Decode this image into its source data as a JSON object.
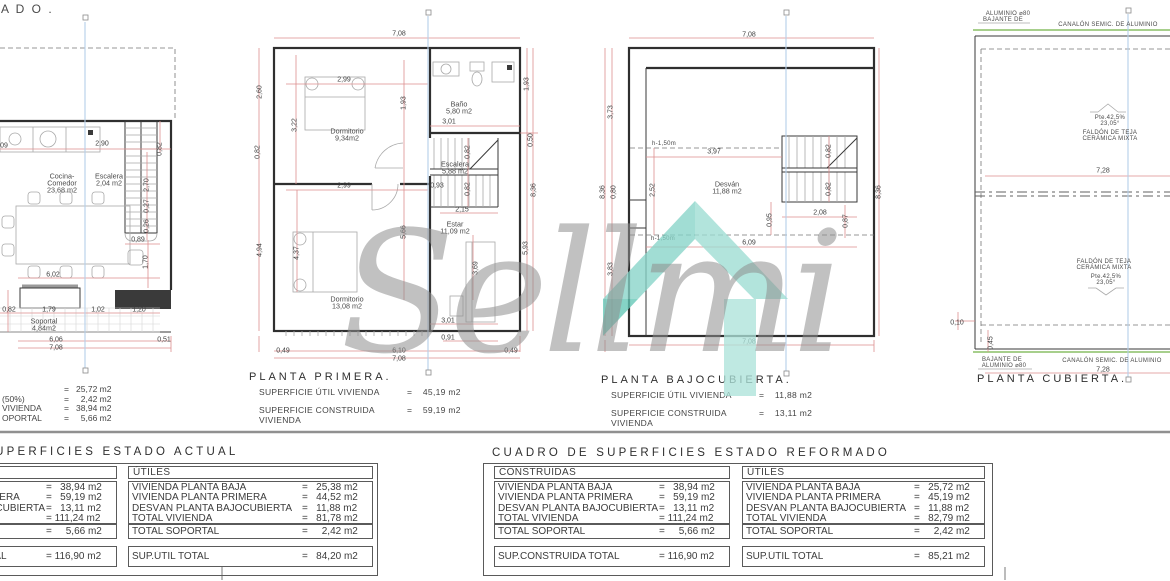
{
  "sheet": {
    "partial_title": "A D O ."
  },
  "watermark": {
    "text": "Sellmi",
    "teal_dark": "#7fd0c2",
    "teal_light": "#aee2d8",
    "gray": "#8f8f8f"
  },
  "captions": {
    "primera": {
      "title": "PLANTA PRIMERA.",
      "lines": [
        {
          "label": "SUPERFICIE ÚTIL VIVIENDA",
          "value": "=    45,19 m2"
        },
        {
          "label": "SUPERFICIE CONSTRUIDA VIVIENDA",
          "value": "=    59,19 m2"
        }
      ]
    },
    "bajocubierta": {
      "title": "PLANTA BAJOCUBIERTA.",
      "lines": [
        {
          "label": "SUPERFICIE ÚTIL VIVIENDA",
          "value": "=    11,88 m2"
        },
        {
          "label": "SUPERFICIE CONSTRUIDA VIVIENDA",
          "value": "=    13,11 m2"
        }
      ]
    },
    "cubierta": {
      "title": "PLANTA CUBIERTA."
    }
  },
  "left_summary": {
    "rows": [
      {
        "label": "",
        "value": "=   25,72 m2"
      },
      {
        "label": "(50%)",
        "value": "=     2,42 m2"
      },
      {
        "label": "VIVIENDA",
        "value": "=   38,94 m2"
      },
      {
        "label": "OPORTAL",
        "value": "=     5,66 m2"
      }
    ]
  },
  "tables": {
    "actual": {
      "title": "CUADRO DE SUPERFICIES ESTADO ACTUAL",
      "construidas": {
        "header": "CONSTRUIDAS",
        "rows": [
          {
            "label": "VIVIENDA PLANTA BAJA",
            "value": "=   38,94 m2"
          },
          {
            "label": "VIVIENDA PLANTA PRIMERA",
            "value": "=   59,19 m2"
          },
          {
            "label": "DESVÁN PLANTA BAJOCUBIERTA",
            "value": "=   13,11 m2"
          },
          {
            "label": "TOTAL VIVIENDA",
            "value": "= 111,24 m2"
          }
        ],
        "soportal": {
          "label": "TOTAL SOPORTAL",
          "value": "=     5,66 m2"
        },
        "total": {
          "label": "SUP.CONSTRUIDA TOTAL",
          "value": "= 116,90 m2"
        }
      },
      "utiles": {
        "header": "ÚTILES",
        "rows": [
          {
            "label": "VIVIENDA PLANTA BAJA",
            "value": "=   25,38 m2"
          },
          {
            "label": "VIVIENDA PLANTA PRIMERA",
            "value": "=   44,52 m2"
          },
          {
            "label": "DESVÁN PLANTA BAJOCUBIERTA",
            "value": "=   11,88 m2"
          },
          {
            "label": "TOTAL VIVIENDA",
            "value": "=   81,78 m2"
          }
        ],
        "soportal": {
          "label": "TOTAL SOPORTAL",
          "value": "=     2,42 m2"
        },
        "total": {
          "label": "SUP.ÚTIL TOTAL",
          "value": "=   84,20 m2"
        }
      }
    },
    "reformado": {
      "title": "CUADRO DE SUPERFICIES ESTADO REFORMADO",
      "construidas": {
        "header": "CONSTRUIDAS",
        "rows": [
          {
            "label": "VIVIENDA PLANTA BAJA",
            "value": "=   38,94 m2"
          },
          {
            "label": "VIVIENDA PLANTA PRIMERA",
            "value": "=   59,19 m2"
          },
          {
            "label": "DESVÁN PLANTA BAJOCUBIERTA",
            "value": "=   13,11 m2"
          },
          {
            "label": "TOTAL VIVIENDA",
            "value": "= 111,24 m2"
          }
        ],
        "soportal": {
          "label": "TOTAL SOPORTAL",
          "value": "=     5,66 m2"
        },
        "total": {
          "label": "SUP.CONSTRUIDA TOTAL",
          "value": "= 116,90 m2"
        }
      },
      "utiles": {
        "header": "ÚTILES",
        "rows": [
          {
            "label": "VIVIENDA PLANTA BAJA",
            "value": "=   25,72 m2"
          },
          {
            "label": "VIVIENDA PLANTA PRIMERA",
            "value": "=   45,19 m2"
          },
          {
            "label": "DESVÁN PLANTA BAJOCUBIERTA",
            "value": "=   11,88 m2"
          },
          {
            "label": "TOTAL VIVIENDA",
            "value": "=   82,79 m2"
          }
        ],
        "soportal": {
          "label": "TOTAL SOPORTAL",
          "value": "=     2,42 m2"
        },
        "total": {
          "label": "SUP.ÚTIL TOTAL",
          "value": "=   85,21 m2"
        }
      }
    }
  },
  "labels": [
    {
      "t": "09",
      "x": 4,
      "y": 146,
      "c": "dim"
    },
    {
      "t": "2,90",
      "x": 102,
      "y": 144,
      "c": "dim"
    },
    {
      "t": "0,82",
      "x": 160,
      "y": 149,
      "r": 1,
      "c": "dim"
    },
    {
      "t": "Escalera",
      "x": 109,
      "y": 176,
      "c": "room"
    },
    {
      "t": "2,04 m2",
      "x": 109,
      "y": 183,
      "c": "room"
    },
    {
      "t": "Cocina-",
      "x": 62,
      "y": 176,
      "c": "room"
    },
    {
      "t": "Comedor",
      "x": 62,
      "y": 183,
      "c": "room"
    },
    {
      "t": "23,68 m2",
      "x": 62,
      "y": 190,
      "c": "room"
    },
    {
      "t": "2,70",
      "x": 147,
      "y": 185,
      "r": 1,
      "c": "dim"
    },
    {
      "t": "0,27",
      "x": 147,
      "y": 206,
      "r": 1,
      "c": "dim"
    },
    {
      "t": "0,26",
      "x": 147,
      "y": 226,
      "r": 1,
      "c": "dim"
    },
    {
      "t": "0,89",
      "x": 138,
      "y": 240,
      "c": "dim"
    },
    {
      "t": "1,70",
      "x": 146,
      "y": 262,
      "r": 1,
      "c": "dim"
    },
    {
      "t": "6,02",
      "x": 53,
      "y": 275,
      "c": "dim"
    },
    {
      "t": "0,82",
      "x": 9,
      "y": 310,
      "c": "dim"
    },
    {
      "t": "1,79",
      "x": 49,
      "y": 310,
      "c": "dim"
    },
    {
      "t": "1,02",
      "x": 98,
      "y": 310,
      "c": "dim"
    },
    {
      "t": "1,20",
      "x": 139,
      "y": 310,
      "c": "dim"
    },
    {
      "t": "Soportal",
      "x": 44,
      "y": 321,
      "c": "room"
    },
    {
      "t": "4,84m2",
      "x": 44,
      "y": 328,
      "c": "room"
    },
    {
      "t": "6,06",
      "x": 56,
      "y": 340,
      "c": "dim"
    },
    {
      "t": "0,51",
      "x": 164,
      "y": 340,
      "c": "dim"
    },
    {
      "t": "7,08",
      "x": 56,
      "y": 348,
      "c": "dim"
    },
    {
      "t": "7,08",
      "x": 399,
      "y": 34,
      "c": "dim"
    },
    {
      "t": "2,99",
      "x": 344,
      "y": 80,
      "c": "dim"
    },
    {
      "t": "2,60",
      "x": 260,
      "y": 92,
      "r": 1,
      "c": "dim"
    },
    {
      "t": "1,93",
      "x": 527,
      "y": 84,
      "r": 1,
      "c": "dim"
    },
    {
      "t": "Dormitorio",
      "x": 347,
      "y": 131,
      "c": "room"
    },
    {
      "t": "9,34m2",
      "x": 347,
      "y": 138,
      "c": "room"
    },
    {
      "t": "Baño",
      "x": 459,
      "y": 104,
      "c": "room"
    },
    {
      "t": "5,80 m2",
      "x": 459,
      "y": 111,
      "c": "room"
    },
    {
      "t": "3,22",
      "x": 295,
      "y": 125,
      "r": 1,
      "c": "dim"
    },
    {
      "t": "1,93",
      "x": 404,
      "y": 103,
      "r": 1,
      "c": "dim"
    },
    {
      "t": "3,01",
      "x": 449,
      "y": 122,
      "c": "dim"
    },
    {
      "t": "0,50",
      "x": 531,
      "y": 140,
      "r": 1,
      "c": "dim"
    },
    {
      "t": "0,82",
      "x": 258,
      "y": 152,
      "r": 1,
      "c": "dim"
    },
    {
      "t": "0,82",
      "x": 468,
      "y": 152,
      "r": 1,
      "c": "dim"
    },
    {
      "t": "0,82",
      "x": 468,
      "y": 189,
      "r": 1,
      "c": "dim"
    },
    {
      "t": "Escalera",
      "x": 455,
      "y": 164,
      "c": "room"
    },
    {
      "t": "5,88 m2",
      "x": 455,
      "y": 171,
      "c": "room"
    },
    {
      "t": "8,36",
      "x": 534,
      "y": 190,
      "r": 1,
      "c": "dim"
    },
    {
      "t": "2,99",
      "x": 344,
      "y": 186,
      "c": "dim"
    },
    {
      "t": "0,93",
      "x": 437,
      "y": 186,
      "c": "dim"
    },
    {
      "t": "2,15",
      "x": 462,
      "y": 210,
      "c": "dim"
    },
    {
      "t": "Estar",
      "x": 455,
      "y": 224,
      "c": "room"
    },
    {
      "t": "11,09 m2",
      "x": 455,
      "y": 231,
      "c": "room"
    },
    {
      "t": "5,66",
      "x": 404,
      "y": 232,
      "r": 1,
      "c": "dim"
    },
    {
      "t": "4,94",
      "x": 260,
      "y": 250,
      "r": 1,
      "c": "dim"
    },
    {
      "t": "4,37",
      "x": 297,
      "y": 253,
      "r": 1,
      "c": "dim"
    },
    {
      "t": "3,69",
      "x": 476,
      "y": 268,
      "r": 1,
      "c": "dim"
    },
    {
      "t": "5,93",
      "x": 526,
      "y": 248,
      "r": 1,
      "c": "dim"
    },
    {
      "t": "Dormitorio",
      "x": 347,
      "y": 299,
      "c": "room"
    },
    {
      "t": "13,08 m2",
      "x": 347,
      "y": 306,
      "c": "room"
    },
    {
      "t": "3,01",
      "x": 448,
      "y": 321,
      "c": "dim"
    },
    {
      "t": "0,91",
      "x": 448,
      "y": 338,
      "c": "dim"
    },
    {
      "t": "0,49",
      "x": 283,
      "y": 351,
      "c": "dim"
    },
    {
      "t": "6,10",
      "x": 399,
      "y": 351,
      "c": "dim"
    },
    {
      "t": "0,49",
      "x": 511,
      "y": 351,
      "c": "dim"
    },
    {
      "t": "7,08",
      "x": 399,
      "y": 359,
      "c": "dim"
    },
    {
      "t": "7,08",
      "x": 749,
      "y": 35,
      "c": "dim"
    },
    {
      "t": "3,73",
      "x": 611,
      "y": 112,
      "r": 1,
      "c": "dim"
    },
    {
      "t": "8,36",
      "x": 603,
      "y": 192,
      "r": 1,
      "c": "dim"
    },
    {
      "t": "0,80",
      "x": 614,
      "y": 192,
      "r": 1,
      "c": "dim"
    },
    {
      "t": "2,52",
      "x": 653,
      "y": 190,
      "r": 1,
      "c": "dim"
    },
    {
      "t": "h-1,50m",
      "x": 664,
      "y": 144,
      "c": "note"
    },
    {
      "t": "3,97",
      "x": 714,
      "y": 152,
      "c": "dim"
    },
    {
      "t": "0,82",
      "x": 829,
      "y": 151,
      "r": 1,
      "c": "dim"
    },
    {
      "t": "0,82",
      "x": 829,
      "y": 189,
      "r": 1,
      "c": "dim"
    },
    {
      "t": "8,36",
      "x": 879,
      "y": 192,
      "r": 1,
      "c": "dim"
    },
    {
      "t": "Desván",
      "x": 727,
      "y": 184,
      "c": "room"
    },
    {
      "t": "11,88 m2",
      "x": 727,
      "y": 191,
      "c": "room"
    },
    {
      "t": "2,08",
      "x": 820,
      "y": 213,
      "c": "dim"
    },
    {
      "t": "0,95",
      "x": 770,
      "y": 220,
      "r": 1,
      "c": "dim"
    },
    {
      "t": "0,87",
      "x": 846,
      "y": 221,
      "r": 1,
      "c": "dim"
    },
    {
      "t": "h-1,50m",
      "x": 663,
      "y": 239,
      "c": "note"
    },
    {
      "t": "6,09",
      "x": 749,
      "y": 243,
      "c": "dim"
    },
    {
      "t": "3,83",
      "x": 611,
      "y": 269,
      "r": 1,
      "c": "dim"
    },
    {
      "t": "7,08",
      "x": 749,
      "y": 342,
      "c": "dim"
    },
    {
      "t": "ALUMINIO  ⌀80",
      "x": 1008,
      "y": 14,
      "c": "note"
    },
    {
      "t": "BAJANTE  DE",
      "x": 1003,
      "y": 20,
      "c": "note"
    },
    {
      "t": "CANALÓN  SEMIC.  DE  ALUMINIO",
      "x": 1108,
      "y": 25,
      "c": "note"
    },
    {
      "t": "Pte.42,5%",
      "x": 1110,
      "y": 118,
      "c": "note"
    },
    {
      "t": "23,05°",
      "x": 1110,
      "y": 124,
      "c": "note"
    },
    {
      "t": "FALDÓN  DE  TEJA",
      "x": 1110,
      "y": 133,
      "c": "note"
    },
    {
      "t": "CERÁMICA  MIXTA",
      "x": 1110,
      "y": 139,
      "c": "note"
    },
    {
      "t": "7,28",
      "x": 1103,
      "y": 171,
      "c": "dim"
    },
    {
      "t": "FALDÓN  DE  TEJA",
      "x": 1104,
      "y": 262,
      "c": "note"
    },
    {
      "t": "CERÁMICA  MIXTA",
      "x": 1104,
      "y": 268,
      "c": "note"
    },
    {
      "t": "Pte.42,5%",
      "x": 1106,
      "y": 277,
      "c": "note"
    },
    {
      "t": "23,05°",
      "x": 1106,
      "y": 283,
      "c": "note"
    },
    {
      "t": "0,10",
      "x": 957,
      "y": 323,
      "c": "dim"
    },
    {
      "t": "0,45",
      "x": 991,
      "y": 343,
      "r": 1,
      "c": "dim"
    },
    {
      "t": "BAJANTE  DE",
      "x": 1002,
      "y": 360,
      "c": "note"
    },
    {
      "t": "ALUMINIO  ⌀80",
      "x": 1004,
      "y": 366,
      "c": "note"
    },
    {
      "t": "CANALÓN  SEMIC.  DE  ALUMINIO",
      "x": 1112,
      "y": 361,
      "c": "note"
    },
    {
      "t": "7,28",
      "x": 1103,
      "y": 370,
      "c": "dim"
    }
  ]
}
